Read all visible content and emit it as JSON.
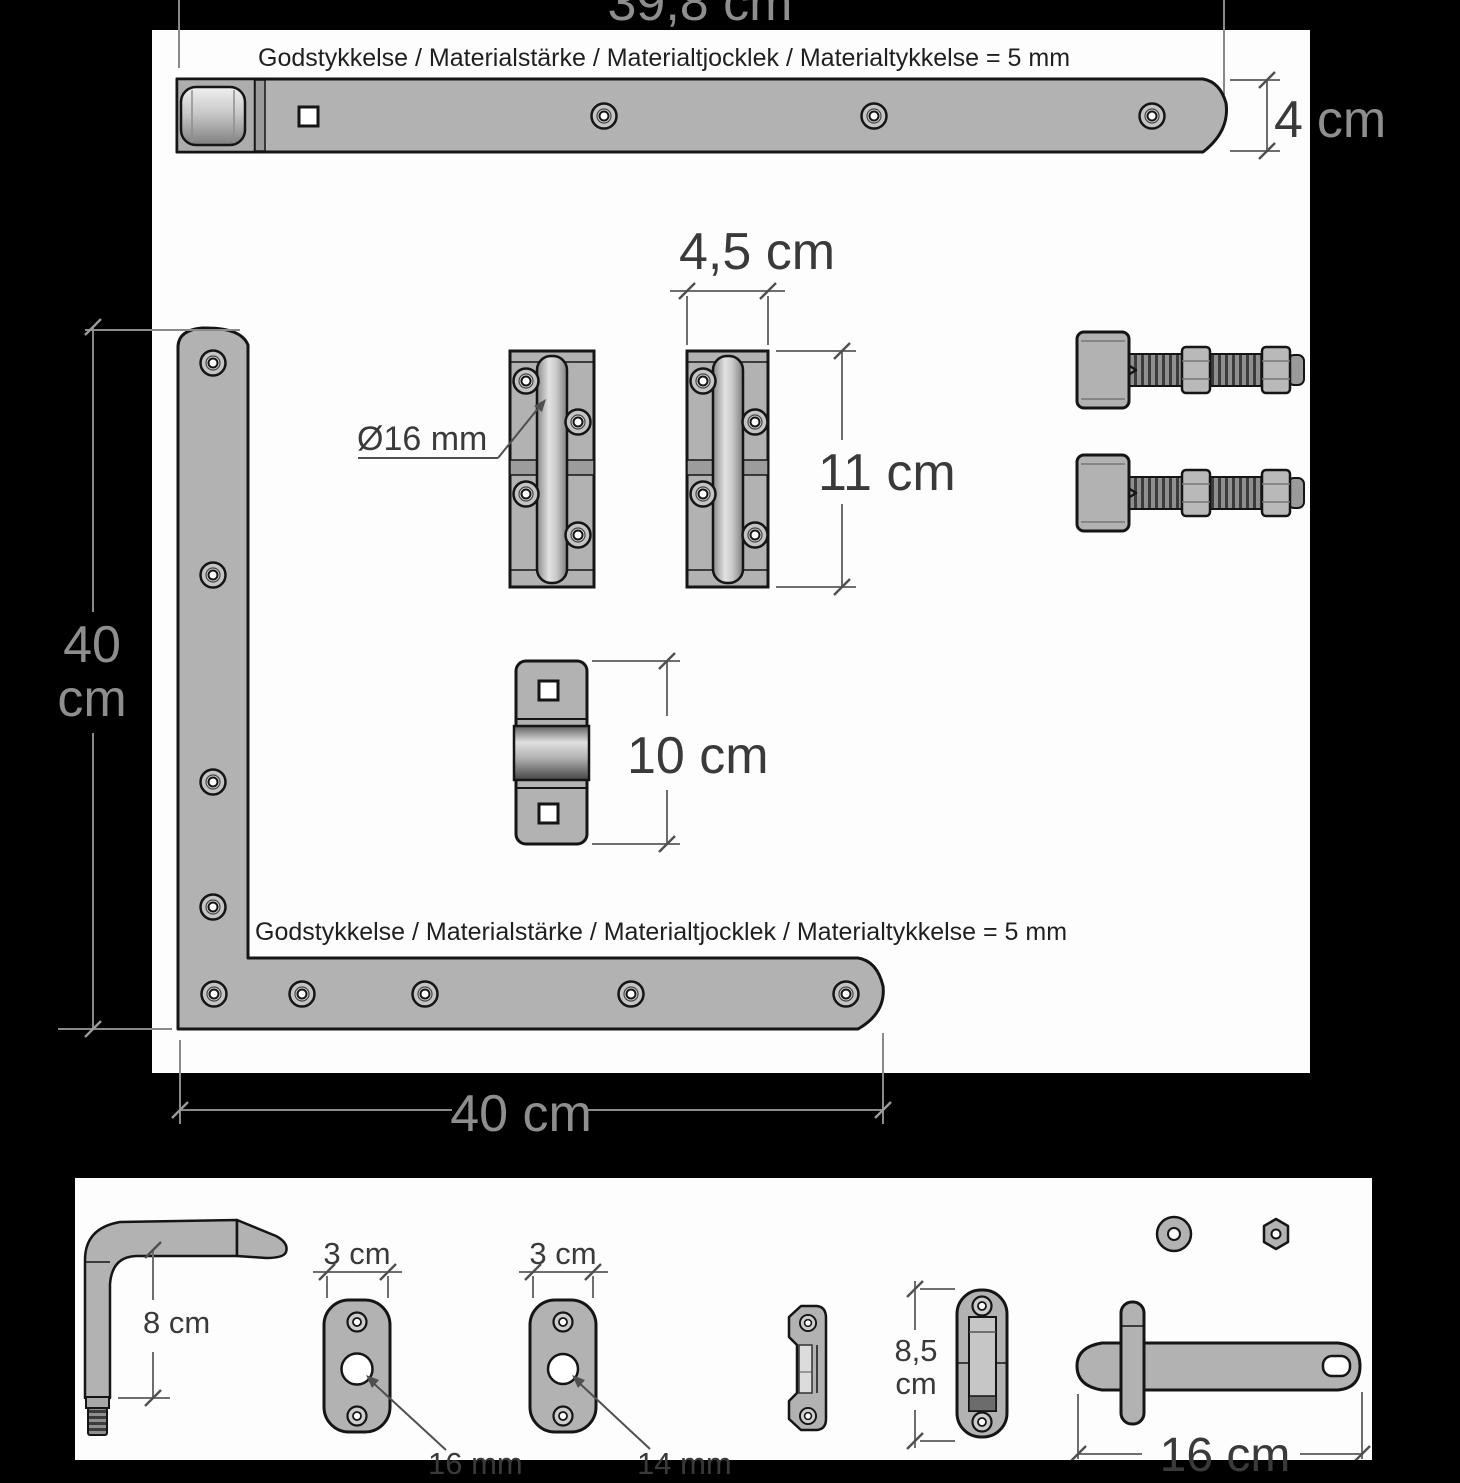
{
  "top_section": {
    "length_label": "39,8 cm",
    "thickness_note": "Godstykkelse / Materialstärke / Materialtjocklek / Materialtykkelse = 5 mm",
    "width_label": {
      "num": "4",
      "unit": "cm"
    }
  },
  "l_hinge": {
    "vertical_label": {
      "num": "40",
      "unit": "cm"
    },
    "horizontal_label": "40 cm",
    "thickness_note": "Godstykkelse / Materialstärke / Materialtjocklek / Materialtykkelse = 5 mm"
  },
  "pin_hinges": {
    "width_label": "4,5 cm",
    "height_label": "11 cm",
    "pin_diameter_label": "Ø16 mm"
  },
  "bracket": {
    "height_label": "10 cm"
  },
  "bottom_section": {
    "pin_height_label": "8 cm",
    "plate1_width_label": "3 cm",
    "plate1_hole_label": "16 mm",
    "plate2_width_label": "3 cm",
    "plate2_hole_label": "14 mm",
    "keeper_height_label": {
      "line1": "8,5",
      "line2": "cm"
    },
    "latch_length_label": "16 cm"
  },
  "colors": {
    "background": "#000000",
    "panel": "#fdfdfd",
    "metal": "#b2b2b2",
    "outline": "#151515",
    "dim_on_white": "#3a3a3a",
    "dim_on_black": "#8e8e8e"
  }
}
